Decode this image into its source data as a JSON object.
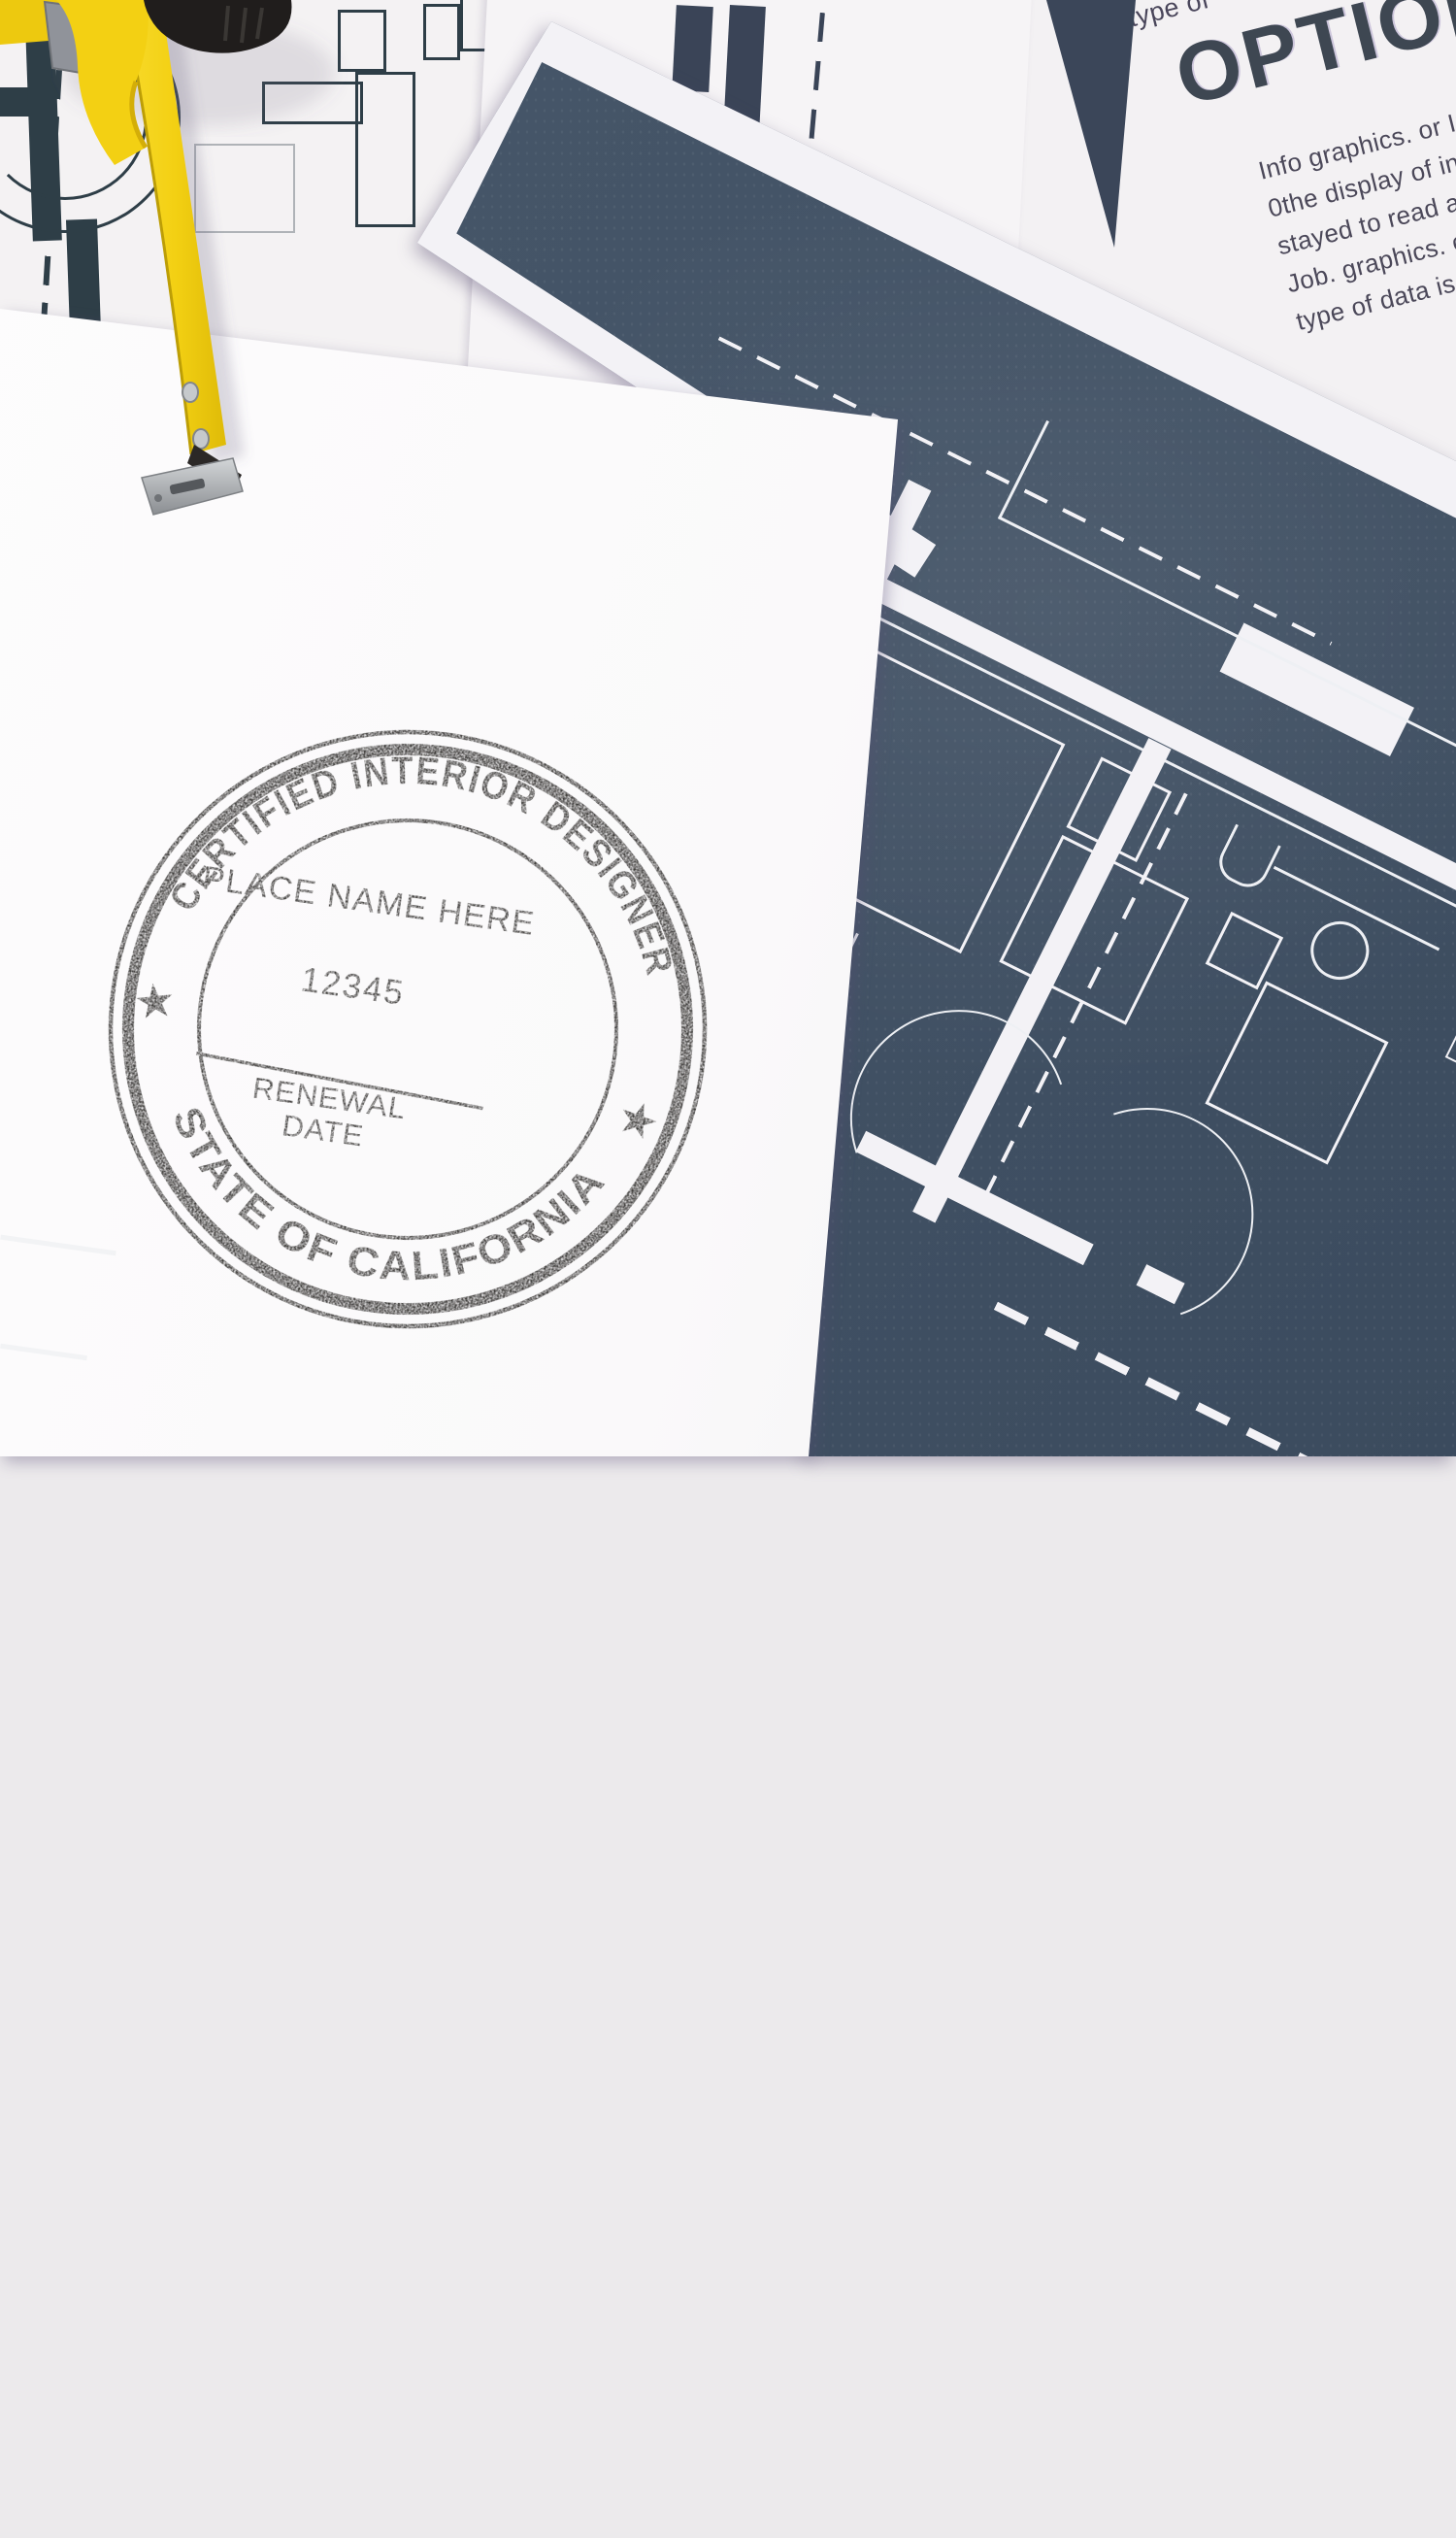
{
  "stamp": {
    "ring_top": "CERTIFIED INTERIOR DESIGNER",
    "ring_bottom": "STATE OF CALIFORNIA",
    "center_line1": "PLACE NAME HERE",
    "center_line2": "12345",
    "renewal_word1": "RENEWAL",
    "renewal_word2": "DATE",
    "star": "★",
    "ink_color": "#23211f"
  },
  "options_doc": {
    "top_partial": "type of",
    "heading": "OPTIONS",
    "body_lines": [
      "Info graphics. or Infor Ch",
      "0the display of informat",
      "stayed to read and eas",
      "Job. graphics. commo",
      "type of data is comp"
    ]
  },
  "colors": {
    "background": "#eceaec",
    "blueprint_navy": "#435366",
    "blueprint_lines": "#f3f2f6",
    "floorplan_print_teal": "#2e3e47",
    "tape_yellow": "#f3d013",
    "stamp_paper": "#fcfbfc"
  }
}
